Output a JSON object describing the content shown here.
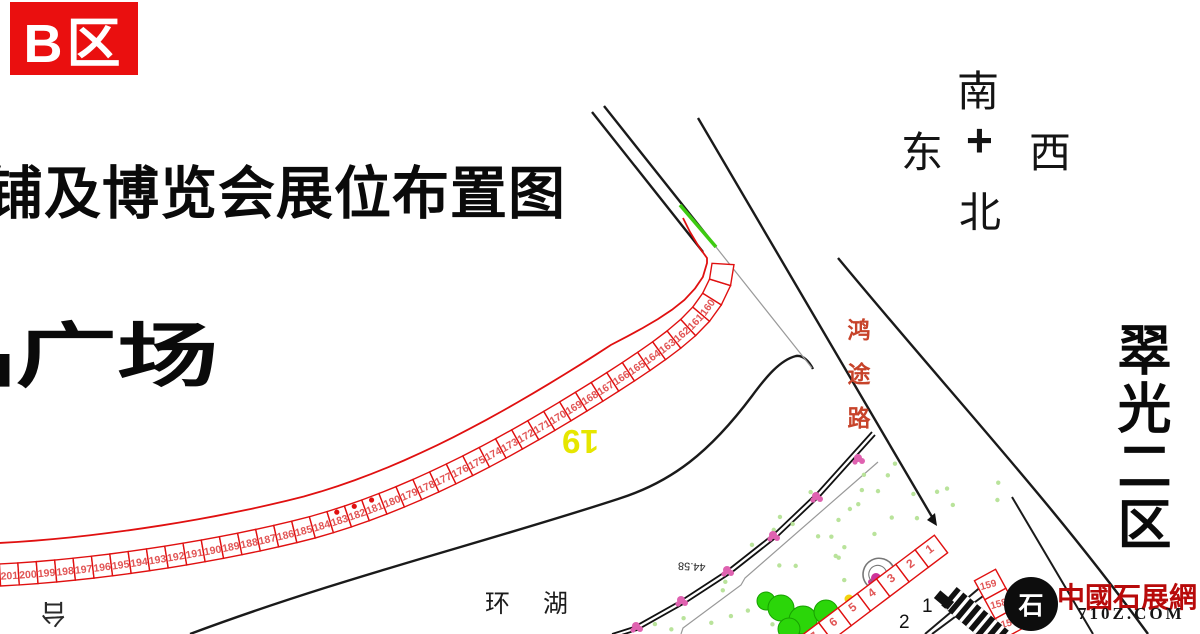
{
  "zone_badge": "B区",
  "title": "铺及博览会展位布置图",
  "plaza_label": "品广场",
  "compass": {
    "top": "南",
    "left": "东",
    "right": "西",
    "bottom": "北",
    "center": "+"
  },
  "right_area_label": "翠光二区",
  "road_label": "鸿途路",
  "lake_label": "环 湖",
  "stage_label": "台",
  "row_label": "19",
  "dim_label": "44.58",
  "plot_marker_1": "1",
  "plot_marker_2": "2",
  "watermark": {
    "site_name": "中國石展網",
    "site_url": "710Z.COM",
    "logo_glyph": "石"
  },
  "strips": [
    {
      "id": "main",
      "number_start": 201,
      "number_end": 160,
      "extra_cells": 2,
      "dot_booths": [
        183,
        182,
        181
      ],
      "width": 22,
      "font": 10.5,
      "outer_line": true
    },
    {
      "id": "corner",
      "number_start": 1,
      "number_end": 7,
      "extra_cells": 0,
      "dot_booths": [],
      "width": 22,
      "font": 12,
      "outer_line": false
    },
    {
      "id": "right",
      "number_start": 159,
      "number_end": 157,
      "extra_cells": 0,
      "dot_booths": [],
      "width": 24,
      "font": 10,
      "outer_line": false,
      "rot_override": -15
    }
  ],
  "colors": {
    "badge_red": "#ea0f0f",
    "booth_outline": "#e01010",
    "booth_number": "#e15555",
    "road_black": "#1a1a1a",
    "green_mark": "#3ecb12",
    "tree_green": "#2bd609",
    "flower_pink": "#df62b0",
    "flower_magenta": "#cc3399",
    "flower_yellow": "#f2d410",
    "scatter_green": "#b9e39b",
    "watermark_red": "#b80a0a",
    "road_label_red": "#c7432a",
    "yellow_label": "#e6e600"
  }
}
